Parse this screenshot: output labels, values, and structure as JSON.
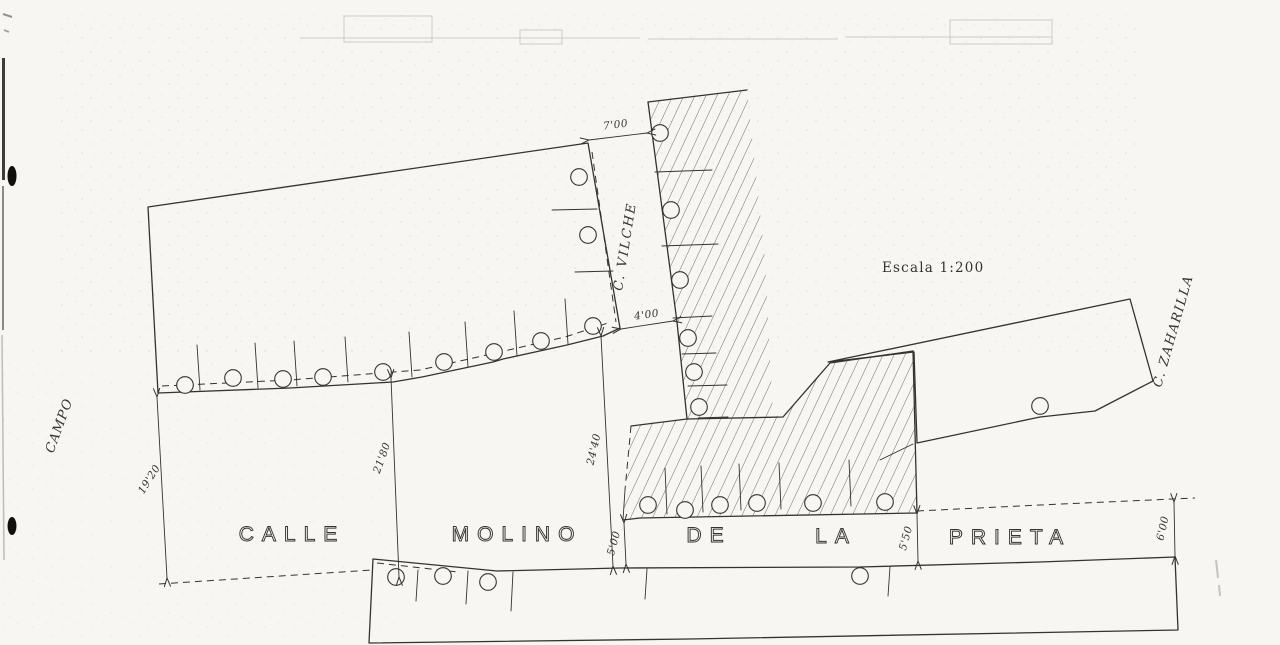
{
  "drawing": {
    "scale_label": "Escala 1:200",
    "street_main": {
      "words": [
        "CALLE",
        "MOLINO",
        "DE",
        "LA",
        "PRIETA"
      ]
    },
    "street_vilche": "C. VILCHE",
    "street_zaharilla": "C. ZAHARILLA",
    "campo_label": "CAMPO",
    "dimensions": [
      {
        "id": "width-vilche-north",
        "label": "7'00"
      },
      {
        "id": "width-vilche-south",
        "label": "4'00"
      },
      {
        "id": "width-street-west",
        "label": "19'20"
      },
      {
        "id": "width-street-mid",
        "label": "21'80"
      },
      {
        "id": "width-street-vilche-mouth",
        "label": "24'40"
      },
      {
        "id": "width-street-center",
        "label": "5'00"
      },
      {
        "id": "width-street-east",
        "label": "5'50"
      },
      {
        "id": "width-street-far-east",
        "label": "6'00"
      }
    ],
    "colors": {
      "paper": "#f7f6f2",
      "ink": "#35332e",
      "hatch": "#4e4b44"
    }
  }
}
